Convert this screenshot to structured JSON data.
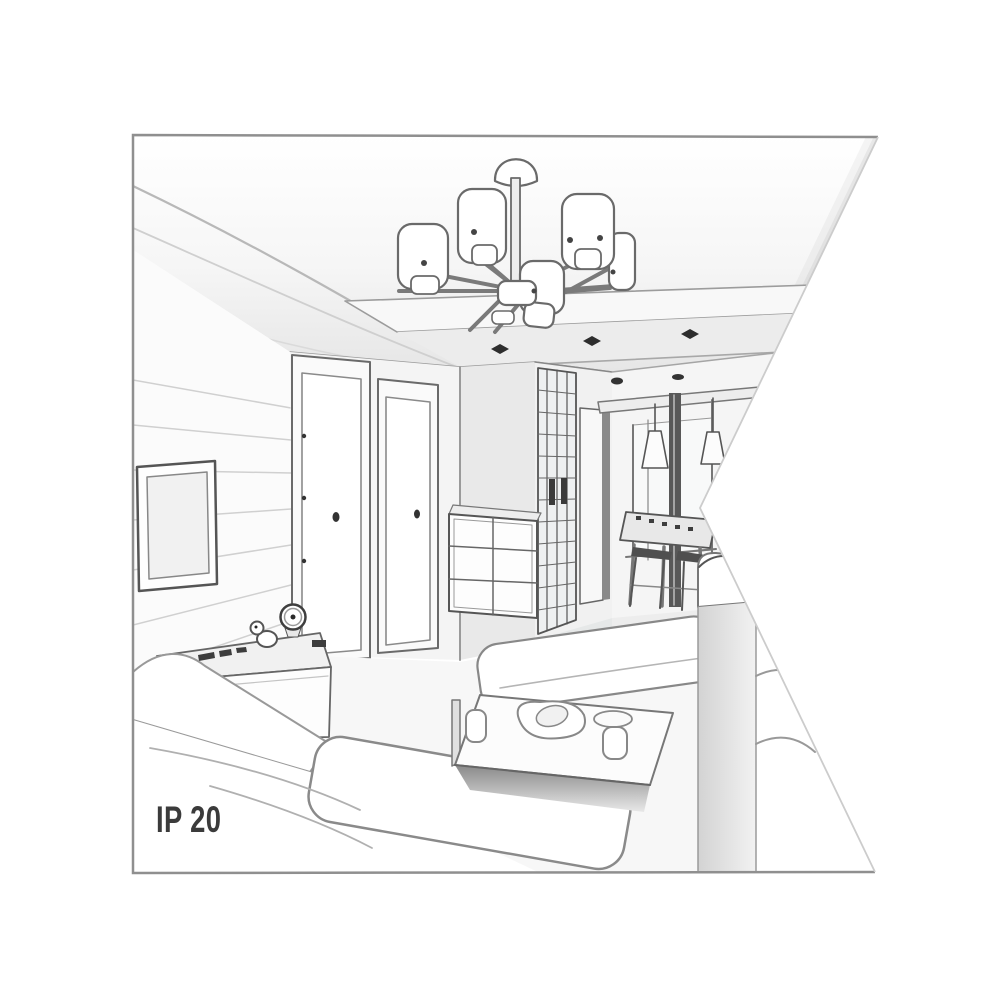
{
  "illustration": {
    "caption": "IP 20",
    "colors": {
      "background": "#ffffff",
      "line": "#777777",
      "line_dark": "#333333",
      "fill_light": "#f4f4f4",
      "caption_text": "#3b3b3b"
    },
    "scene_objects": [
      "ceiling-chandelier-with-cylindrical-shades",
      "recessed-ceiling-spotlights",
      "wall-tv-panel",
      "interior-door-left",
      "interior-door-right",
      "hallway-wardrobe",
      "hallway-door",
      "drawer-chest",
      "tv-sideboard",
      "table-clock",
      "duck-figurine",
      "left-sofa",
      "seat-cushion",
      "ottoman-bench",
      "coffee-table-with-dishes",
      "right-sofa",
      "dining-table",
      "bar-stools",
      "cone-pendant-lamps",
      "window"
    ]
  }
}
